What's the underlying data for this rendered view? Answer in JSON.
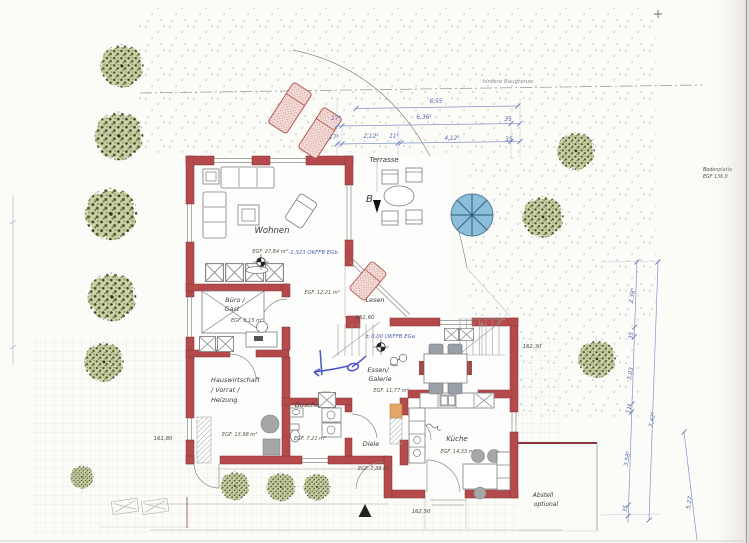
{
  "site": {
    "rear_boundary_label": "hintere Baugrenze",
    "slab_note_line1": "Bodenplatte",
    "slab_note_line2": "EGF 136,8",
    "shed_line1": "Abstell",
    "shed_line2": "optional"
  },
  "rooms": {
    "terrasse": {
      "name": "Terrasse"
    },
    "wohnen": {
      "name": "Wohnen",
      "area": "EGF. 27,84 m²",
      "level": "-1,323 OKFFB EGb"
    },
    "lesen": {
      "name": "Lesen",
      "area": "EGF. 12,21 m²"
    },
    "buero": {
      "name_line1": "Büro /",
      "name_line2": "Gast",
      "area": "EGF. 8,15 m²"
    },
    "hauswirtschaft": {
      "name_line1": "Hauswirtschaft",
      "name_line2": "/ Vorrat /",
      "name_line3": "Heizung",
      "area": "EGF. 13,98 m²"
    },
    "dusche": {
      "name": "Dusche",
      "area": "EGF. 7,21 m²"
    },
    "diele": {
      "name": "Diele",
      "area": "EGF. 7,38 m²"
    },
    "kueche": {
      "name": "Küche",
      "area": "EGF. 14,33 m²"
    },
    "essen": {
      "name_line1": "Essen/",
      "name_line2": "Galerie",
      "area": "EGF. 11,77 m²",
      "level": "± 0,00 OKFFB EGa"
    }
  },
  "spot_heights": {
    "left": "161,80",
    "stair": "161,60",
    "entrance": "162,50",
    "east": "162,30"
  },
  "section_marker": {
    "label": "B"
  },
  "dimensions": {
    "top_row1": {
      "total": "6,55"
    },
    "top_row2": {
      "d1": "17⁵",
      "d2": "6,36⁵",
      "d3": "35"
    },
    "top_row3": {
      "d1": "17⁵",
      "d2": "2,12⁵",
      "d3": "11⁵",
      "d4": "4,12⁵",
      "d5": "35"
    },
    "right_chain": {
      "d1": "2,38⁵",
      "d2": "35",
      "d3": "3,03",
      "d4": "11⁵",
      "d5": "3,58⁵",
      "d6": "35"
    },
    "right_total": "7,42⁵",
    "right_outer": "5,27"
  },
  "colors": {
    "wall_red": "#b5494b",
    "dimension_blue": "#5a68ad",
    "pen_annotation_blue": "#2b36c2",
    "parasol_blue": "#8cbdd9",
    "lounger_pink": "#f6dfdb",
    "tree_green": "#cbd1a6"
  }
}
